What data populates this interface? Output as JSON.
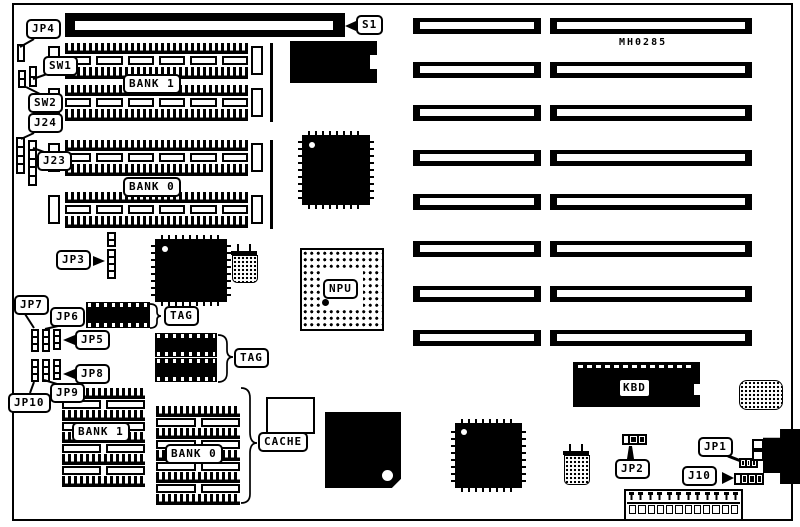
{
  "diagram": {
    "part_number": "MH0285",
    "callouts": {
      "s1": "S1",
      "jp4": "JP4",
      "sw1": "SW1",
      "sw2": "SW2",
      "j24": "J24",
      "j23": "J23",
      "jp3": "JP3",
      "jp7": "JP7",
      "jp6": "JP6",
      "jp5": "JP5",
      "jp8": "JP8",
      "jp9": "JP9",
      "jp10": "JP10",
      "jp2": "JP2",
      "jp1": "JP1",
      "j10": "J10"
    },
    "chips": {
      "bios": "BIOS",
      "npu": "NPU",
      "cpu": "CPU",
      "kbd": "KBD",
      "u42": "U42",
      "u32": "U32",
      "u33": "U33"
    },
    "memory_banks": {
      "bank1": "BANK 1",
      "bank0": "BANK 0"
    },
    "cache_banks": {
      "bank1": "BANK 1",
      "bank0": "BANK 0"
    },
    "group_labels": {
      "cache": "CACHE",
      "tag_u42": "TAG",
      "tag_u32_u33": "TAG"
    },
    "colors": {
      "ink": "#000000",
      "paper": "#ffffff"
    }
  }
}
